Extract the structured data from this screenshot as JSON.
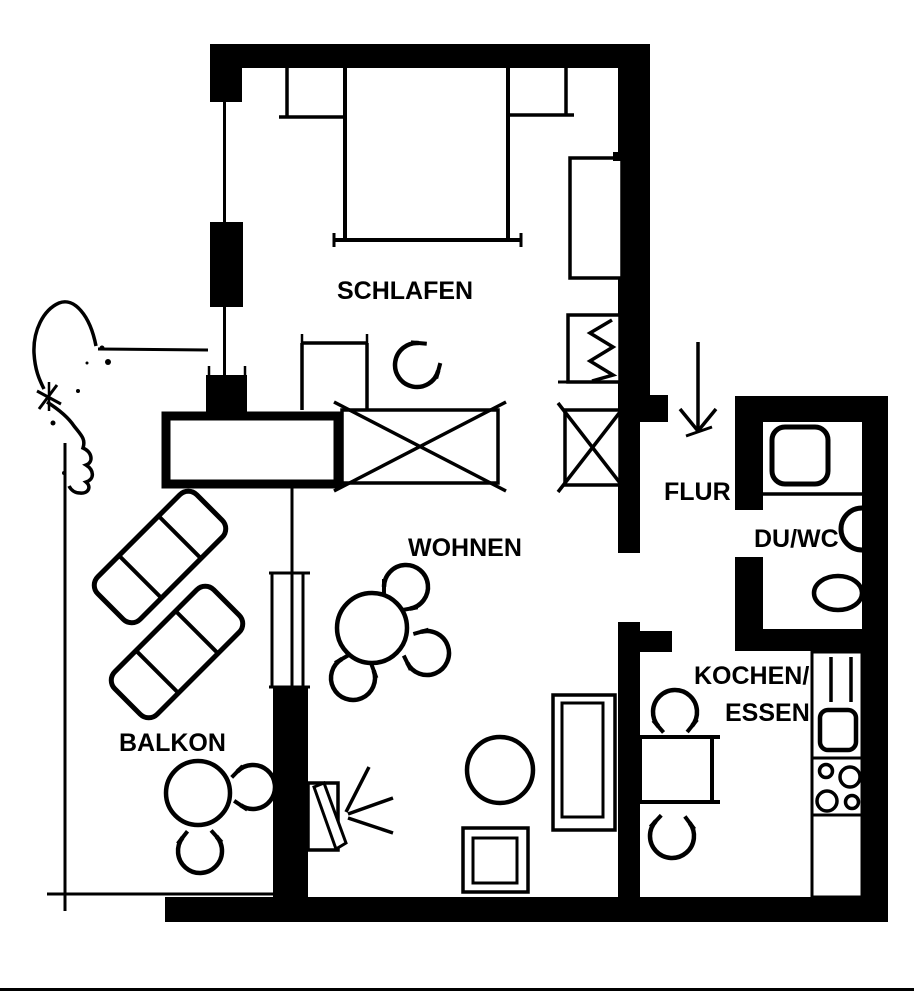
{
  "colors": {
    "ink": "#000000",
    "paper": "#ffffff"
  },
  "labels": {
    "schlafen": "SCHLAFEN",
    "wohnen": "WOHNEN",
    "flur": "FLUR",
    "du_wc": "DU/WC",
    "kochen": "KOCHEN/",
    "essen": "ESSEN",
    "balkon": "BALKON"
  }
}
